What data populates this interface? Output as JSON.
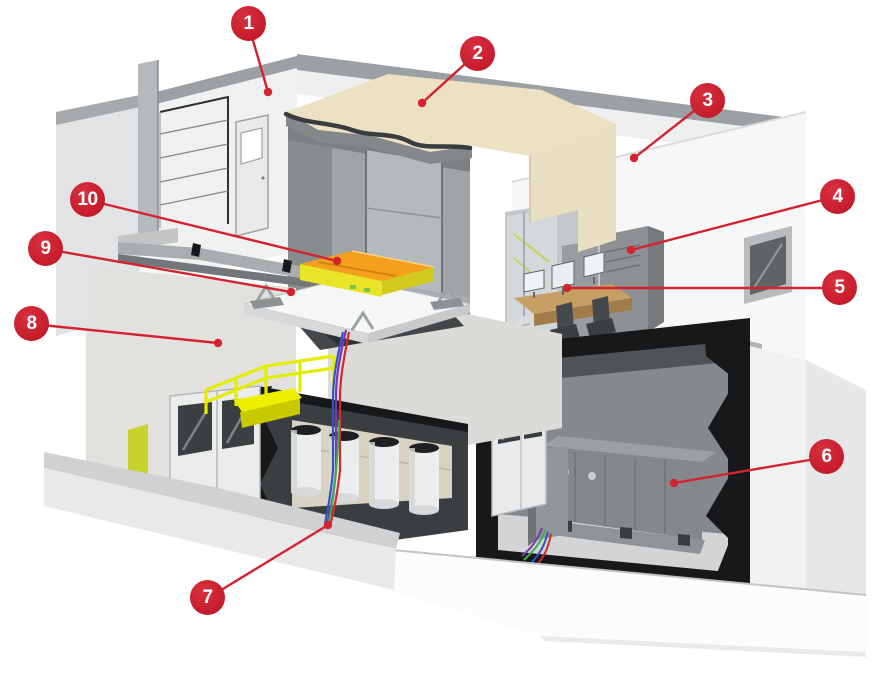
{
  "figure": {
    "kind": "isometric-cutaway-illustration",
    "background": "#ffffff"
  },
  "callouts": [
    {
      "number": "1"
    },
    {
      "number": "2"
    },
    {
      "number": "3"
    },
    {
      "number": "4"
    },
    {
      "number": "5"
    },
    {
      "number": "6"
    },
    {
      "number": "7"
    },
    {
      "number": "8"
    },
    {
      "number": "9"
    },
    {
      "number": "10"
    }
  ],
  "palette": {
    "badge_red": "#c41c2b",
    "leader_red": "#d2232f",
    "roof_tan": "#ece2c3",
    "cream_wall": "#e9dfc1",
    "table_orange": "#f5a01d",
    "table_yellow": "#e9e427",
    "table_yellow_dark": "#d2cb1e",
    "safety_yellow": "#e4ec00",
    "landing_yellow": "#eef000",
    "landing_yellow_dark": "#c9c900",
    "cut_black": "#17181a",
    "machine_gray": "#84888d",
    "desk_tan": "#c79e63",
    "cable_red": "#d32b2b",
    "cable_blue": "#2f55c8",
    "cable_green": "#3fae4a",
    "cable_purple": "#7b35b5",
    "wall_white": "#f0f1f1",
    "wall_band_gray": "#9aa0a3"
  }
}
